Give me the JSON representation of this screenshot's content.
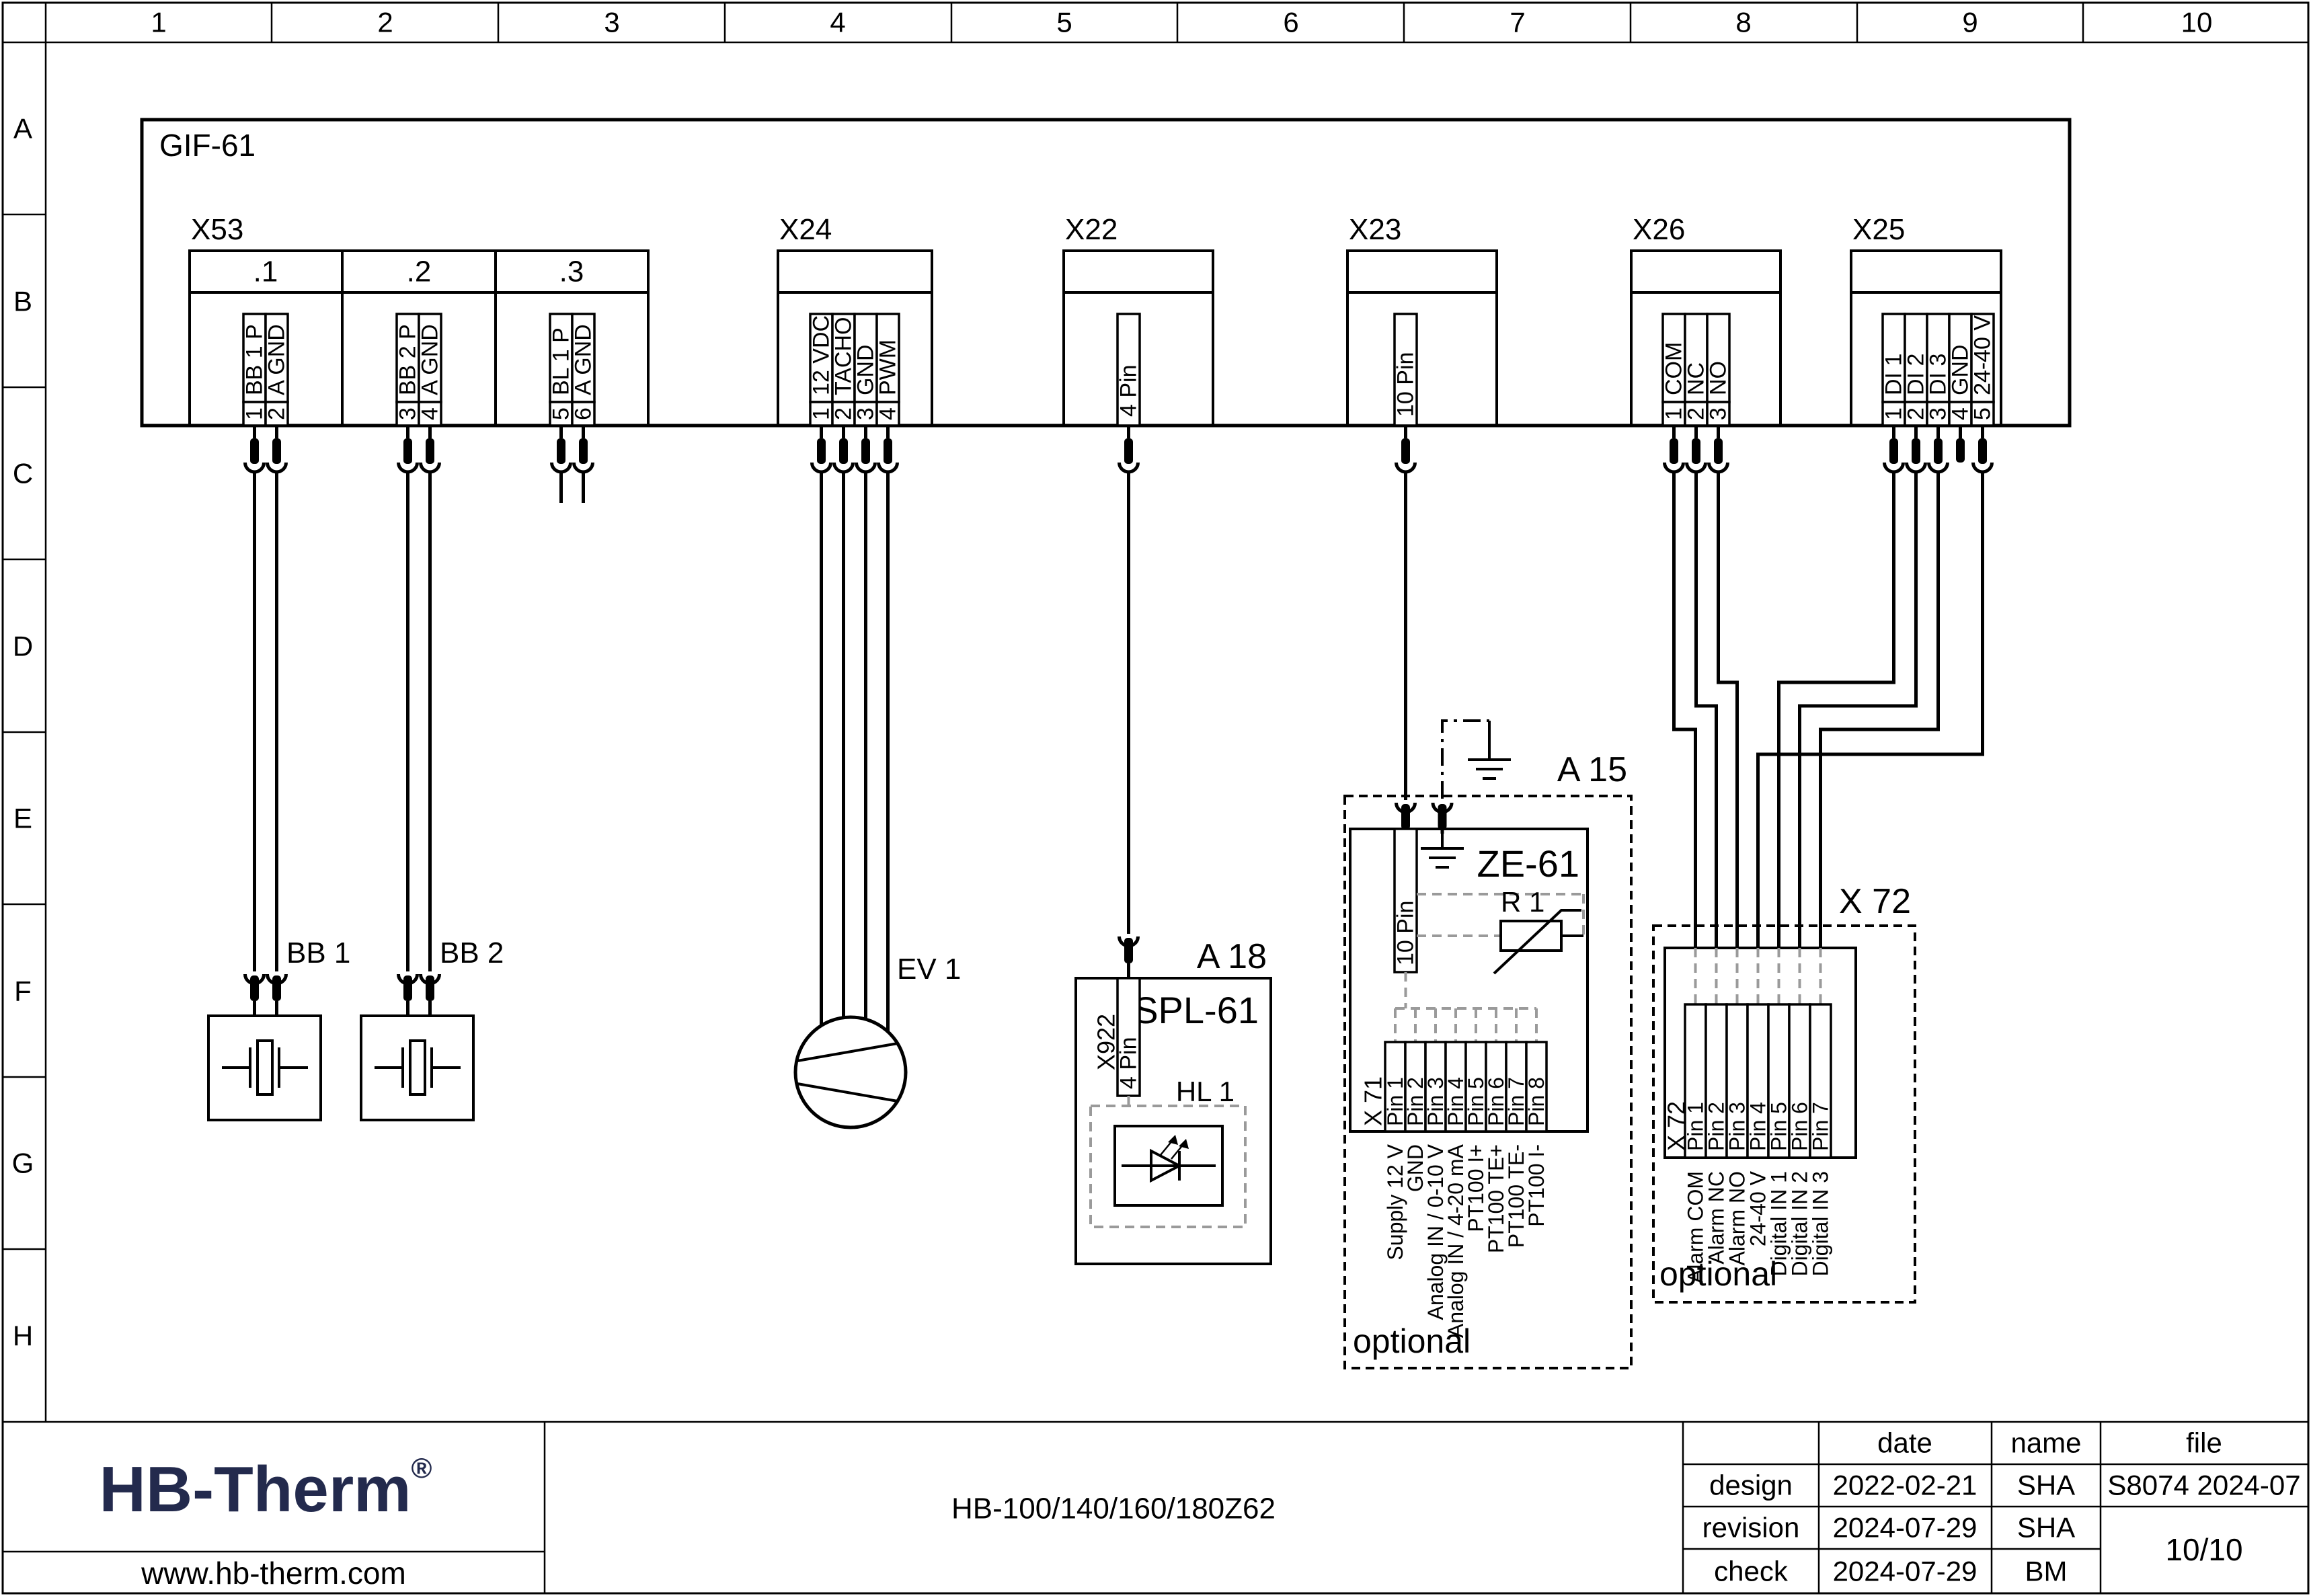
{
  "page": {
    "ruler_cols": [
      "1",
      "2",
      "3",
      "4",
      "5",
      "6",
      "7",
      "8",
      "9",
      "10"
    ],
    "ruler_rows": [
      "A",
      "B",
      "C",
      "D",
      "E",
      "F",
      "G",
      "H"
    ]
  },
  "board": {
    "label": "GIF-61"
  },
  "x53": {
    "label": "X53",
    "cells": [
      ".1",
      ".2",
      ".3"
    ],
    "pins": [
      {
        "n": "1",
        "t": "BB 1 P"
      },
      {
        "n": "2",
        "t": "A GND"
      },
      {
        "n": "3",
        "t": "BB 2 P"
      },
      {
        "n": "4",
        "t": "A GND"
      },
      {
        "n": "5",
        "t": "BL 1 P"
      },
      {
        "n": "6",
        "t": "A GND"
      }
    ]
  },
  "x24": {
    "label": "X24",
    "pins": [
      {
        "n": "1",
        "t": "12 VDC"
      },
      {
        "n": "2",
        "t": "TACHO"
      },
      {
        "n": "3",
        "t": "GND"
      },
      {
        "n": "4",
        "t": "PWM"
      }
    ]
  },
  "x22": {
    "label": "X22",
    "pin": "4 Pin"
  },
  "x23": {
    "label": "X23",
    "pin": "10 Pin"
  },
  "x26": {
    "label": "X26",
    "pins": [
      {
        "n": "1",
        "t": "COM"
      },
      {
        "n": "2",
        "t": "NC"
      },
      {
        "n": "3",
        "t": "NO"
      }
    ]
  },
  "x25": {
    "label": "X25",
    "pins": [
      {
        "n": "1",
        "t": "DI 1"
      },
      {
        "n": "2",
        "t": "DI 2"
      },
      {
        "n": "3",
        "t": "DI 3"
      },
      {
        "n": "4",
        "t": "GND"
      },
      {
        "n": "5",
        "t": "24-40 V"
      }
    ]
  },
  "devices": {
    "bb1": "BB 1",
    "bb2": "BB 2",
    "ev1": "EV 1"
  },
  "a18": {
    "ref": "A 18",
    "name": "SPL-61",
    "conn_label": "X922",
    "conn_pin": "4 Pin",
    "hl": "HL 1"
  },
  "a15": {
    "ref": "A 15",
    "name": "ZE-61",
    "pin": "10 Pin",
    "r1": "R 1",
    "optional": "optional",
    "x71": "X 71",
    "x71_pins": [
      "Pin 1",
      "Pin 2",
      "Pin 3",
      "Pin 4",
      "Pin 5",
      "Pin 6",
      "Pin 7",
      "Pin 8"
    ],
    "x71_signals": [
      "Supply 12 V",
      "GND",
      "Analog IN / 0-10 V",
      "Analog IN / 4-20 mA",
      "PT100 I+",
      "PT100 TE+",
      "PT100 TE-",
      "PT100 I-"
    ]
  },
  "x72": {
    "title": "X 72",
    "label": "X 72",
    "optional": "optional",
    "pins": [
      "Pin 1",
      "Pin 2",
      "Pin 3",
      "Pin 4",
      "Pin 5",
      "Pin 6",
      "Pin 7"
    ],
    "signals": [
      "Alarm COM",
      "Alarm NC",
      "Alarm NO",
      "24-40 V",
      "Digital IN 1",
      "Digital IN 2",
      "Digital IN 3"
    ]
  },
  "titleblock": {
    "logo": "HB-Therm",
    "reg": "®",
    "url": "www.hb-therm.com",
    "model": "HB-100/140/160/180Z62",
    "date_h": "date",
    "name_h": "name",
    "file_h": "file",
    "design": "design",
    "design_date": "2022-02-21",
    "design_name": "SHA",
    "revision": "revision",
    "revision_date": "2024-07-29",
    "revision_name": "SHA",
    "check": "check",
    "check_date": "2024-07-29",
    "check_name": "BM",
    "file_value": "S8074 2024-07",
    "page": "10/10"
  },
  "colors": {
    "logo_navy": "#232a4d",
    "dashed_grey": "#9a9a9a",
    "line": "#000000"
  }
}
